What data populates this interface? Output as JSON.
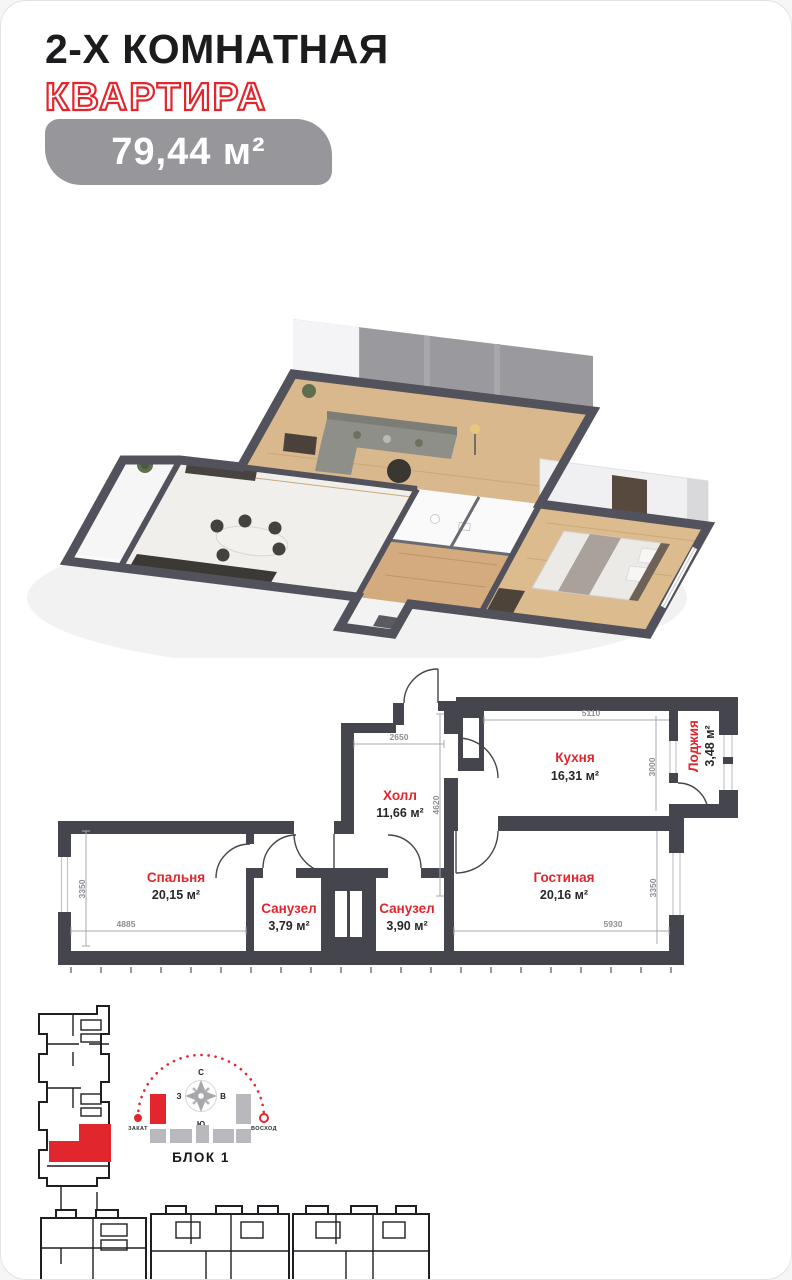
{
  "header": {
    "title_black": "2-Х КОМНАТНАЯ",
    "title_red": "КВАРТИРА",
    "area_badge": "79,44 м²"
  },
  "floorplan": {
    "rooms": {
      "hall": {
        "name": "Холл",
        "area": "11,66 м²"
      },
      "kitchen": {
        "name": "Кухня",
        "area": "16,31 м²"
      },
      "loggia": {
        "name": "Лоджия",
        "area": "3,48 м²"
      },
      "bedroom": {
        "name": "Спальня",
        "area": "20,15 м²"
      },
      "bath1": {
        "name": "Санузел",
        "area": "3,79 м²"
      },
      "bath2": {
        "name": "Санузел",
        "area": "3,90 м²"
      },
      "living": {
        "name": "Гостиная",
        "area": "20,16 м²"
      }
    },
    "dims": {
      "hall_w": "2650",
      "hall_h": "4620",
      "kitchen_w": "5110",
      "kitchen_h": "3000",
      "bedroom_h": "3350",
      "bedroom_w": "4885",
      "living_w": "5930",
      "living_h": "3350"
    }
  },
  "site_plan": {
    "block_label": "БЛОК 1",
    "sunset": "ЗАКАТ",
    "sunrise": "ВОСХОД",
    "compass": {
      "n": "С",
      "s": "Ю",
      "w": "З",
      "e": "В"
    }
  },
  "colors": {
    "accent": "#e2262d",
    "wall": "#45454d",
    "badge": "#97979b"
  }
}
